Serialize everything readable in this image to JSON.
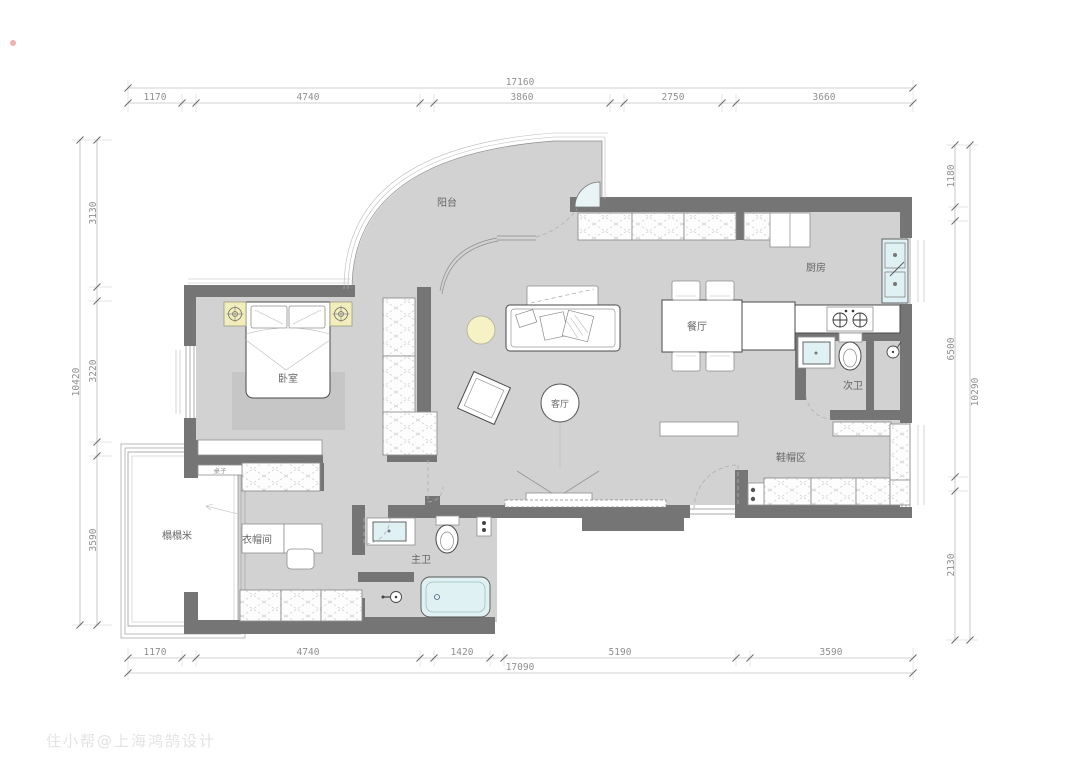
{
  "watermark": {
    "text": "住小帮@上海鸿鹄设计"
  },
  "dims": {
    "top": {
      "total": "17160",
      "segments": [
        "1170",
        "4740",
        "3860",
        "2750",
        "3660"
      ]
    },
    "bottom": {
      "total": "17090",
      "segments": [
        "1170",
        "4740",
        "1420",
        "5190",
        "3590"
      ]
    },
    "left": {
      "total": "10420",
      "segments": [
        "3130",
        "3220",
        "3590"
      ]
    },
    "right": {
      "total": "10290",
      "segments": [
        "1180",
        "6500",
        "2130"
      ]
    }
  },
  "rooms": {
    "balcony": "阳台",
    "bedroom": "卧室",
    "living_room": "客厅",
    "dining_room": "餐厅",
    "kitchen": "厨房",
    "second_bath": "次卫",
    "shoe_area": "鞋帽区",
    "tatami": "榻榻米",
    "cloakroom": "衣帽间",
    "master_bath": "主卫"
  },
  "furniture": {
    "desk_label": "桌子"
  },
  "colors": {
    "wall": "#757575",
    "floor": "#d2d2d2",
    "fixture_cyan": "#e0f1f3",
    "accent_yellow": "#f2eebb",
    "dim_text": "#8f8f8f"
  }
}
